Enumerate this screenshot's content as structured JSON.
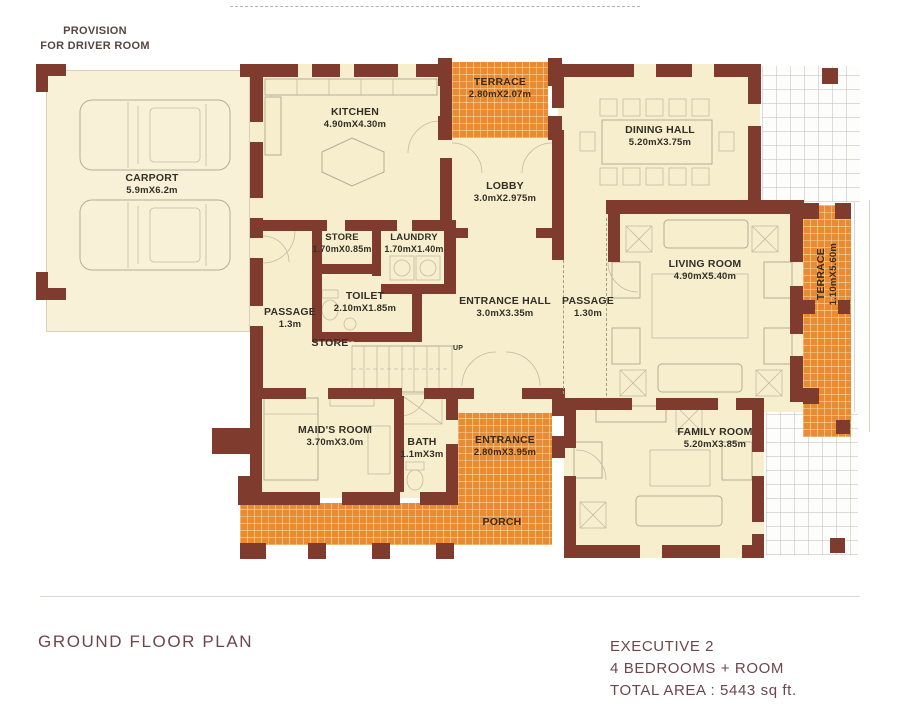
{
  "plan": {
    "provision": {
      "line1": "PROVISION",
      "line2": "FOR DRIVER ROOM"
    },
    "up_label": "UP",
    "rooms": {
      "carport": {
        "name": "CARPORT",
        "dims": "5.9mX6.2m"
      },
      "kitchen": {
        "name": "KITCHEN",
        "dims": "4.90mX4.30m"
      },
      "terrace_top": {
        "name": "TERRACE",
        "dims": "2.80mX2.07m"
      },
      "dining_hall": {
        "name": "DINING HALL",
        "dims": "5.20mX3.75m"
      },
      "lobby": {
        "name": "LOBBY",
        "dims": "3.0mX2.975m"
      },
      "store": {
        "name": "STORE",
        "dims": "1.70mX0.85m"
      },
      "laundry": {
        "name": "LAUNDRY",
        "dims": "1.70mX1.40m"
      },
      "toilet": {
        "name": "TOILET",
        "dims": "2.10mX1.85m"
      },
      "passage_left": {
        "name": "PASSAGE",
        "dims": "1.3m"
      },
      "store_under_stairs": {
        "name": "STORE"
      },
      "entrance_hall": {
        "name": "ENTRANCE HALL",
        "dims": "3.0mX3.35m"
      },
      "passage_right": {
        "name": "PASSAGE",
        "dims": "1.30m"
      },
      "living_room": {
        "name": "LIVING ROOM",
        "dims": "4.90mX5.40m"
      },
      "terrace_right": {
        "name": "TERRACE",
        "dims": "1.10mX5.60m"
      },
      "maids_room": {
        "name": "MAID'S ROOM",
        "dims": "3.70mX3.0m"
      },
      "bath": {
        "name": "BATH",
        "dims": "1.1mX3m"
      },
      "entrance": {
        "name": "ENTRANCE",
        "dims": "2.80mX3.95m"
      },
      "porch": {
        "name": "PORCH"
      },
      "family_room": {
        "name": "FAMILY ROOM",
        "dims": "5.20mX3.85m"
      }
    }
  },
  "footer": {
    "plan_title": "GROUND FLOOR PLAN",
    "model_name": "EXECUTIVE 2",
    "bedrooms_line": "4 BEDROOMS + ROOM",
    "total_area_line": "TOTAL AREA : 5443 sq ft."
  },
  "colors": {
    "wall": "#7f3c2e",
    "room_fill": "#f6eecd",
    "terrace_fill": "#e98b33",
    "label_text": "#332f27",
    "footer_text": "#6d464b"
  }
}
